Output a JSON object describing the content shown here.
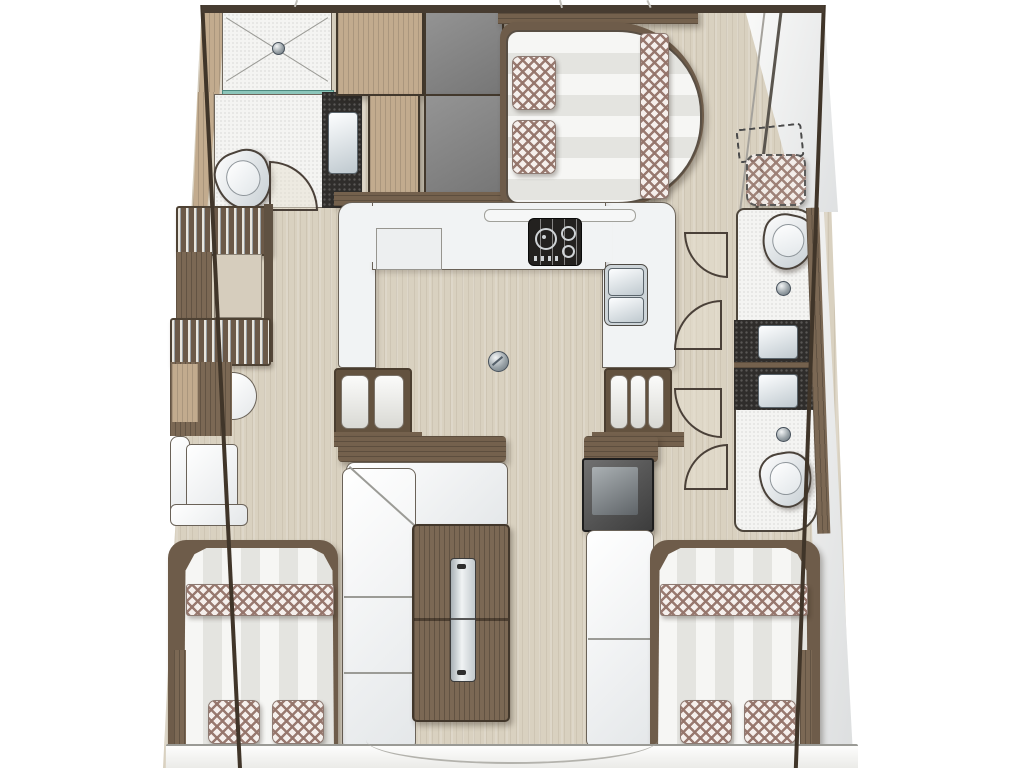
{
  "title": "Catamaran interior deck plan (top view)",
  "palette": {
    "hull_outline": "#403529",
    "cabin_floor": "#d9d1c0",
    "wood_furniture": "#7b6854",
    "wood_light": "#c2ab8e",
    "locker_gray": "#8a8a8a",
    "counter_dark": "#2f2d2b",
    "fixture_white": "#f1f3f4",
    "upholstery_plaid": "#96746c",
    "mattress_stripe": "#e4e4e0",
    "shower_glass": "#8cc6ba"
  },
  "rooms": {
    "forward_bathroom": {
      "label": "Forward head: shower, WC, washbasin"
    },
    "wardrobes": {
      "label": "Wardrobes and lockers"
    },
    "forward_cabin": {
      "label": "Forward double berth"
    },
    "side_deck": {
      "label": "Starboard passage with optional berth (dashed)"
    },
    "galley": {
      "label": "U-shaped galley: stove, worktop, double sink"
    },
    "salon": {
      "label": "Salon: L-sofa and folding table"
    },
    "nav_bench": {
      "label": "Bench seat with cool-box"
    },
    "steps_port": {
      "label": "Companionway steps to port hull"
    },
    "steps_starboard": {
      "label": "Companionway steps to starboard hull"
    },
    "starboard_head_fwd": {
      "label": "Starboard forward head"
    },
    "starboard_head_aft": {
      "label": "Starboard aft head"
    },
    "aft_cabin_port": {
      "label": "Port aft double berth"
    },
    "aft_cabin_starboard": {
      "label": "Starboard aft double berth"
    },
    "transom": {
      "label": "Aft platform"
    }
  },
  "fixtures": [
    "shower-tray",
    "toilet",
    "washbasin",
    "stove",
    "double-sink",
    "floor-drain",
    "folding-table",
    "pillows",
    "plaid-runner",
    "door-swing",
    "louvered-steps"
  ]
}
